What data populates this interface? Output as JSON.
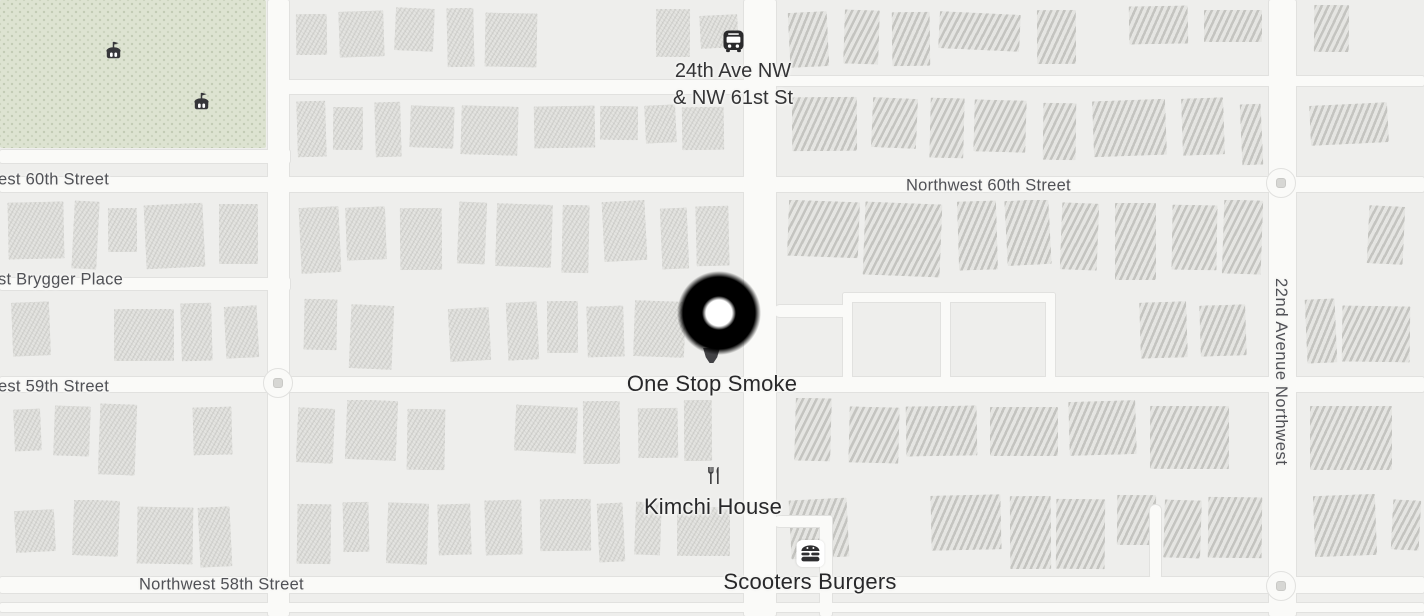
{
  "map": {
    "kind": "street-map",
    "transit_stop": {
      "icon": "bus-icon",
      "line1": "24th Ave NW",
      "line2": "& NW 61st St"
    },
    "streets": {
      "w60th": "est 60th Street",
      "brygger": "st Brygger Place",
      "w59th": "est 59th Street",
      "nw58th": "Northwest 58th Street",
      "nw60th": "Northwest 60th Street",
      "ave22": "22nd Avenue Northwest"
    },
    "pois": {
      "one_stop_smoke": {
        "name": "One Stop Smoke",
        "icon": "pin-tip"
      },
      "kimchi_house": {
        "name": "Kimchi House",
        "icon": "restaurant-icon"
      },
      "scooters_burgers": {
        "name": "Scooters Burgers",
        "icon": "burger-icon"
      }
    },
    "park": {
      "icons": [
        "carousel-icon",
        "carousel-icon"
      ]
    },
    "marker": {
      "type": "selection-circle"
    },
    "colors": {
      "base": "#eeeeec",
      "road_fill": "#fafaf8",
      "road_casing": "#e1e1df",
      "park": "#dde3d1",
      "street_label": "#505156",
      "poi_label": "#28282a",
      "transit_label": "#343436",
      "marker": "#000000",
      "marker_center": "#ffffff",
      "pin": "#424245",
      "icon": "#2e2e30"
    }
  }
}
